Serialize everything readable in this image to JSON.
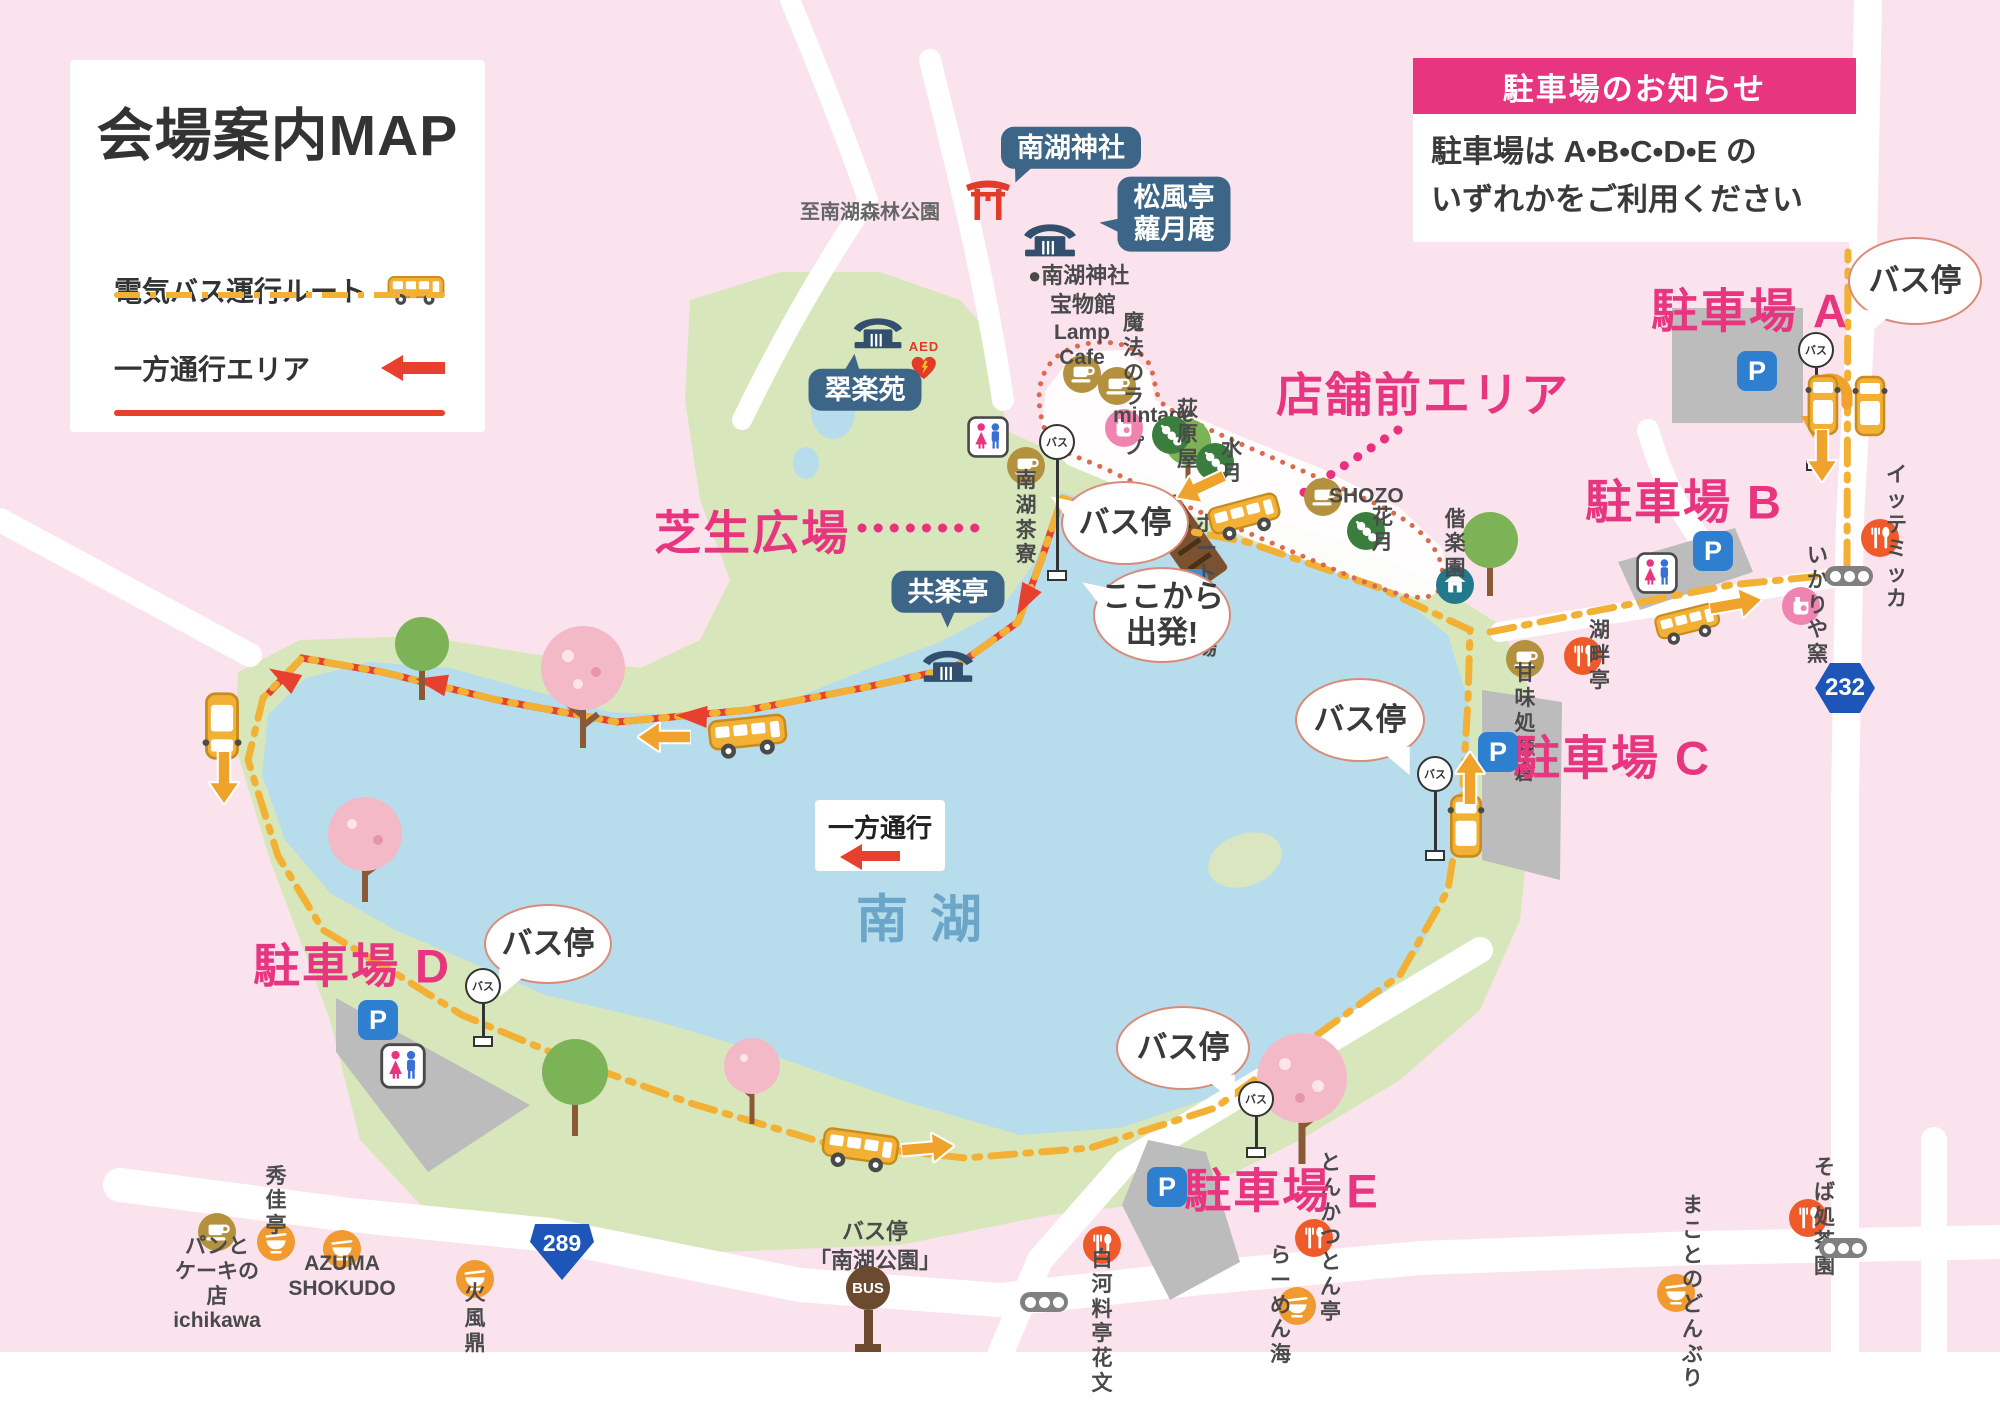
{
  "legend": {
    "title": "会場案内MAP",
    "bus_route_label": "電気バス運行ルート",
    "one_way_label": "一方通行エリア"
  },
  "notice": {
    "header": "駐車場のお知らせ",
    "line1": "駐車場は A•B•C•D•E の",
    "line2": "いずれかをご利用ください"
  },
  "lake": {
    "name": "南湖"
  },
  "signs": {
    "one_way": "一方通行",
    "bus_pole": "バス",
    "bus_terminal": "BUS",
    "terminal_label": "バス停\n「南湖公園」",
    "aed": "AED",
    "to_forest_park": "至南湖森林公園",
    "treasure_hall": "●南湖神社\n　宝物館"
  },
  "road_signs": [
    {
      "id": "route-232",
      "type": "prefectural-hexagon",
      "number": "232"
    },
    {
      "id": "route-289",
      "type": "national-shield",
      "number": "289"
    }
  ],
  "area_labels": {
    "storefront": "店舗前エリア",
    "lawn": "芝生広場"
  },
  "parking": {
    "p_label": "P",
    "lots": [
      {
        "id": "a",
        "label": "駐車場 A"
      },
      {
        "id": "b",
        "label": "駐車場 B"
      },
      {
        "id": "c",
        "label": "駐車場 C"
      },
      {
        "id": "d",
        "label": "駐車場 D"
      },
      {
        "id": "e",
        "label": "駐車場 E"
      }
    ]
  },
  "speech_bubbles": [
    {
      "id": "bus-stop-start",
      "text": "バス停"
    },
    {
      "id": "bus-stop-a",
      "text": "バス停"
    },
    {
      "id": "bus-stop-c",
      "text": "バス停"
    },
    {
      "id": "bus-stop-d",
      "text": "バス停"
    },
    {
      "id": "bus-stop-e",
      "text": "バス停"
    },
    {
      "id": "depart-here",
      "text": "ここから\n出発!"
    }
  ],
  "place_bubbles": [
    {
      "id": "nanko-jinja",
      "text": "南湖神社"
    },
    {
      "id": "shofutei-ragetsuan",
      "text": "松風亭\n蘿月庵"
    },
    {
      "id": "suirakuen",
      "text": "翠楽苑"
    },
    {
      "id": "kyorakutei",
      "text": "共楽亭"
    }
  ],
  "pois": [
    {
      "id": "lamp-cafe",
      "icon": "cafe",
      "label": "Lamp Cafe"
    },
    {
      "id": "maho-no-lamp",
      "icon": "cafe",
      "label": "魔法のランプ"
    },
    {
      "id": "mintage",
      "icon": "kiln",
      "label": "mintage"
    },
    {
      "id": "ogiwaraya",
      "icon": "dango",
      "label": "荻原屋"
    },
    {
      "id": "suigetsu",
      "icon": "dango",
      "label": "水月"
    },
    {
      "id": "shozo",
      "icon": "cafe",
      "label": "SHOZO"
    },
    {
      "id": "kagetsu",
      "icon": "dango",
      "label": "花月"
    },
    {
      "id": "kairakuen",
      "icon": "house",
      "label": "偕楽園"
    },
    {
      "id": "nanko-saryo",
      "icon": "cafe",
      "label": "南湖茶寮"
    },
    {
      "id": "boat-dock",
      "icon": "boat",
      "label": "ボート乗り場"
    },
    {
      "id": "kohantei",
      "icon": "rest",
      "label": "湖畔亭"
    },
    {
      "id": "ittemikka",
      "icon": "rest",
      "label": "イッテ\nミッカ"
    },
    {
      "id": "ikariya-gama",
      "icon": "kiln",
      "label": "いかりや窯"
    },
    {
      "id": "kanmidokoro-kamakura",
      "icon": "cafe",
      "label": "甘味処\n鎌倉"
    },
    {
      "id": "tonkatsu-tontei",
      "icon": "rest",
      "label": "とんかつとん亭"
    },
    {
      "id": "soba-chaen",
      "icon": "rest",
      "label": "そば処茶園"
    },
    {
      "id": "makoto-no-donburi",
      "icon": "bowl",
      "label": "まことの\nどんぶり"
    },
    {
      "id": "ramen-umi",
      "icon": "bowl",
      "label": "らーめん海"
    },
    {
      "id": "shirakawa-hanabumi",
      "icon": "rest",
      "label": "白河料亭\n花文"
    },
    {
      "id": "kafutei",
      "icon": "bowl",
      "label": "火風鼎"
    },
    {
      "id": "azuma-shokudo",
      "icon": "bowl",
      "label": "AZUMA\nSHOKUDO"
    },
    {
      "id": "shukatei",
      "icon": "bowl",
      "label": "秀佳亭"
    },
    {
      "id": "ichikawa",
      "icon": "cafe",
      "label": "パンと\nケーキの店\nichikawa"
    }
  ],
  "colors": {
    "accent_pink": "#e8357f",
    "route_yellow": "#f2b135",
    "one_way_red": "#e8402e",
    "lake_blue": "#b7dcec",
    "park_green": "#d8e7bb",
    "bubble_blue": "#3d6587"
  }
}
